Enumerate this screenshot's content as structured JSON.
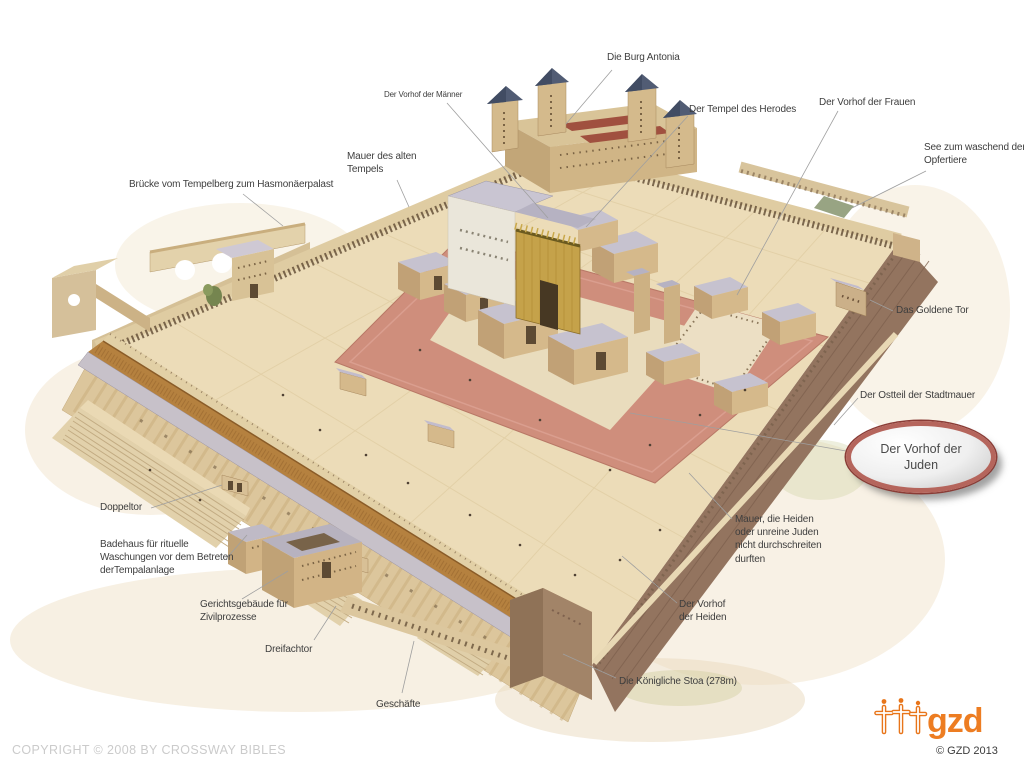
{
  "slide": {
    "labels": {
      "burg_antonia": {
        "lines": [
          "Die Burg Antonia"
        ]
      },
      "vorhof_maenner": {
        "lines": [
          "Der Vorhof der Männer"
        ]
      },
      "tempel_herodes": {
        "lines": [
          "Der Tempel des Herodes"
        ]
      },
      "vorhof_frauen": {
        "lines": [
          "Der Vorhof der Frauen"
        ]
      },
      "see_opfertiere": {
        "lines": [
          "See zum waschend der",
          "Opfertiere"
        ]
      },
      "mauer_alten_tempels": {
        "lines": [
          "Mauer des alten",
          "Tempels"
        ]
      },
      "bruecke": {
        "lines": [
          "Brücke vom Tempelberg zum Hasmonäerpalast"
        ]
      },
      "goldene_tor": {
        "lines": [
          "Das Goldene Tor"
        ]
      },
      "ostteil_stadtmauer": {
        "lines": [
          "Der Ostteil der Stadtmauer"
        ]
      },
      "mauer_heiden": {
        "lines": [
          "Mauer, die Heiden",
          "oder unreine Juden",
          "nicht durchschreiten",
          "durften"
        ]
      },
      "vorhof_heiden": {
        "lines": [
          "Der Vorhof",
          "der Heiden"
        ]
      },
      "koenigliche_stoa": {
        "lines": [
          "Die Königliche Stoa (278m)"
        ]
      },
      "doppeltor": {
        "lines": [
          "Doppeltor"
        ]
      },
      "badehaus": {
        "lines": [
          "Badehaus für rituelle",
          "Waschungen vor dem Betreten",
          "derTempalanlage"
        ]
      },
      "gerichtsgebaeude": {
        "lines": [
          "Gerichtsgebäude für",
          "Zivilprozesse"
        ]
      },
      "dreifachtor": {
        "lines": [
          "Dreifachtor"
        ]
      },
      "geschaefte": {
        "lines": [
          "Geschäfte"
        ]
      }
    },
    "callout": {
      "lines": [
        "Der Vorhof der",
        "Juden"
      ]
    },
    "copyright": "COPYRIGHT © 2008 BY CROSSWAY BIBLES",
    "logo": {
      "text": "gzd",
      "year": "© GZD 2013"
    },
    "palette": {
      "accent_orange": "#ED7D22",
      "callout_ring": "#B5655C",
      "callout_ring_dark": "#8A3C36",
      "label_text": "#3E3E3E",
      "copyright_gray": "#CBCBCB",
      "esplanade": "#ECDCB8",
      "inner_court_pink": "#CF8E7C",
      "stoa_roof": "#B5813F",
      "east_wall": "#93745F",
      "tower_roof": "#515C74",
      "temple_gold": "#C5A24A"
    }
  }
}
